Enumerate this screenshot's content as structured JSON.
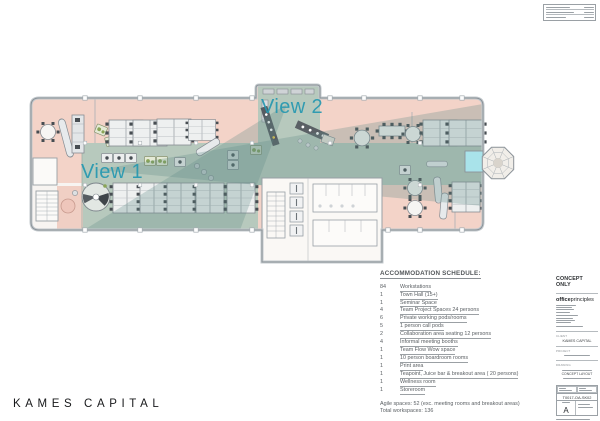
{
  "plan": {
    "view1_label": "View 1",
    "view2_label": "View 2",
    "colors": {
      "floor_pink": "#f3d3c8",
      "floor_sage": "#b7c9bd",
      "view_cone": "rgba(92,138,133,0.28)",
      "accent_teal": "#2598b0",
      "cyan_room": "#a9e3ea"
    }
  },
  "schedule": {
    "title": "ACCOMMODATION SCHEDULE:",
    "items": [
      {
        "qty": "84",
        "desc": "Workstations"
      },
      {
        "qty": "1",
        "desc": "Town Hall (15+)"
      },
      {
        "qty": "1",
        "desc": "Seminar Space"
      },
      {
        "qty": "4",
        "desc": "Team Project Spaces 24 persons"
      },
      {
        "qty": "6",
        "desc": "Private working pods/rooms"
      },
      {
        "qty": "5",
        "desc": "1 person call pods"
      },
      {
        "qty": "2",
        "desc": "Collaboration area seating 12 persons"
      },
      {
        "qty": "4",
        "desc": "Informal meeting booths"
      },
      {
        "qty": "1",
        "desc": "Team Flow Wow space"
      },
      {
        "qty": "1",
        "desc": "10 person boardroom rooms"
      },
      {
        "qty": "1",
        "desc": "Print area"
      },
      {
        "qty": "1",
        "desc": "Teapoint, Juice bar  & breakout area ( 20  persons)"
      },
      {
        "qty": "1",
        "desc": "Wellness room"
      },
      {
        "qty": "1",
        "desc": "Storeroom"
      }
    ],
    "summary1": "Agile spaces: 52  (exc. meeting rooms and breakout areas)",
    "summary2": "Total workspaces: 136"
  },
  "titleblock": {
    "concept": "CONCEPT ONLY",
    "logo_bold": "office",
    "logo_light": "principles",
    "client_label": "CLIENT",
    "client": "KAMES CAPITAL",
    "project_label": "PROJECT",
    "drawing_label": "DRAWING",
    "drawing_title": "CONCEPT LAYOUT",
    "number": "T0017-OA-SK02",
    "revision": "A"
  },
  "footer": {
    "brand": "KAMES CAPITAL"
  }
}
